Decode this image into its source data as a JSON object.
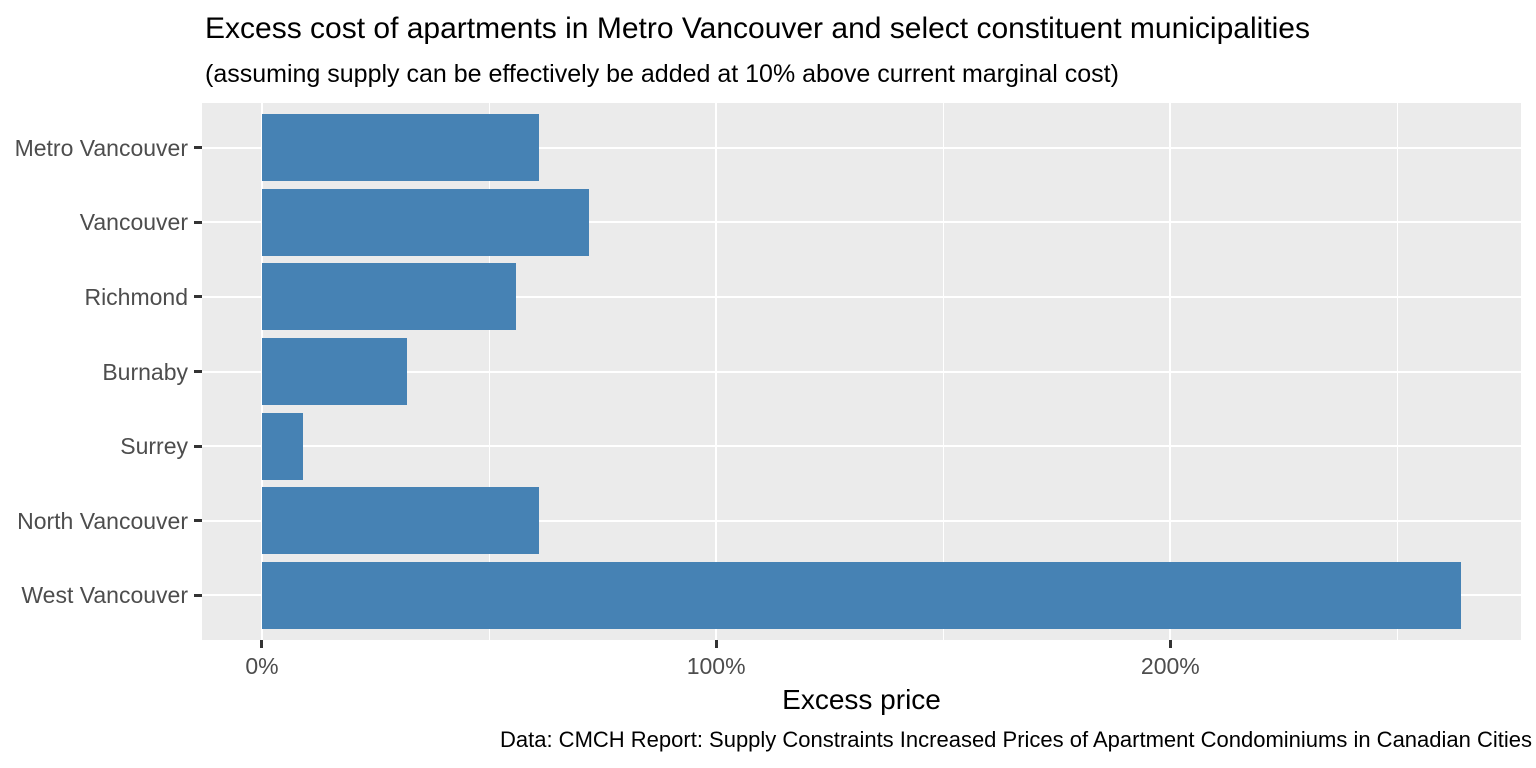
{
  "chart_data": {
    "type": "bar",
    "orientation": "horizontal",
    "title": "Excess cost of apartments in Metro Vancouver and select constituent municipalities",
    "subtitle": "(assuming supply can be effectively be added at 10% above current marginal cost)",
    "caption": "Data: CMCH Report: Supply Constraints Increased Prices of Apartment Condominiums in Canadian Cities",
    "xlabel": "Excess price",
    "ylabel": "",
    "categories": [
      "Metro Vancouver",
      "Vancouver",
      "Richmond",
      "Burnaby",
      "Surrey",
      "North Vancouver",
      "West Vancouver"
    ],
    "values": [
      61,
      72,
      56,
      32,
      9,
      61,
      264
    ],
    "value_unit": "%",
    "x_ticks": [
      {
        "value": 0,
        "label": "0%"
      },
      {
        "value": 100,
        "label": "100%"
      },
      {
        "value": 200,
        "label": "200%"
      }
    ],
    "x_minor_ticks": [
      50,
      150,
      250
    ],
    "xlim": [
      -13.2,
      277.2
    ],
    "grid": "on",
    "legend": "none",
    "bar_color": "#4682B4",
    "panel_background": "#EBEBEB",
    "gridline_color": "#FFFFFF",
    "tick_color": "#333333",
    "axis_text_color": "#4D4D4D",
    "text_color": "#000000"
  }
}
